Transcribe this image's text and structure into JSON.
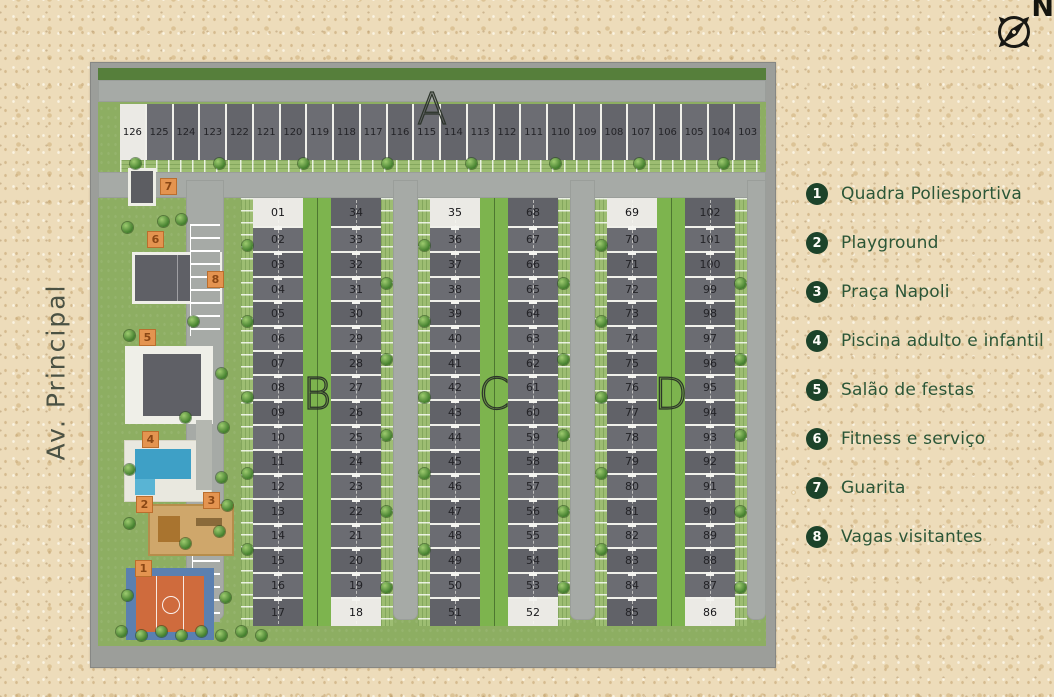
{
  "street_label": "Av. Principal",
  "compass": {
    "north_label": "N"
  },
  "legend": {
    "items": [
      {
        "num": "1",
        "label": "Quadra Poliesportiva"
      },
      {
        "num": "2",
        "label": "Playground"
      },
      {
        "num": "3",
        "label": "Praça Napoli"
      },
      {
        "num": "4",
        "label": "Piscina adulto e infantil"
      },
      {
        "num": "5",
        "label": "Salão de festas"
      },
      {
        "num": "6",
        "label": "Fitness e serviço"
      },
      {
        "num": "7",
        "label": "Guarita"
      },
      {
        "num": "8",
        "label": "Vagas visitantes"
      }
    ]
  },
  "map": {
    "row_a": {
      "label": "A",
      "lots": [
        "126",
        "125",
        "124",
        "123",
        "122",
        "121",
        "120",
        "119",
        "118",
        "117",
        "116",
        "115",
        "114",
        "113",
        "112",
        "111",
        "110",
        "109",
        "108",
        "107",
        "106",
        "105",
        "104",
        "103"
      ]
    },
    "blocks": [
      {
        "label": "B",
        "left_lots": [
          "01",
          "02",
          "03",
          "04",
          "05",
          "06",
          "07",
          "08",
          "09",
          "10",
          "11",
          "12",
          "13",
          "14",
          "15",
          "16",
          "17"
        ],
        "right_lots": [
          "34",
          "33",
          "32",
          "31",
          "30",
          "29",
          "28",
          "27",
          "26",
          "25",
          "24",
          "23",
          "22",
          "21",
          "20",
          "19",
          "18"
        ]
      },
      {
        "label": "C",
        "left_lots": [
          "35",
          "36",
          "37",
          "38",
          "39",
          "40",
          "41",
          "42",
          "43",
          "44",
          "45",
          "46",
          "47",
          "48",
          "49",
          "50",
          "51"
        ],
        "right_lots": [
          "68",
          "67",
          "66",
          "65",
          "64",
          "63",
          "62",
          "61",
          "60",
          "59",
          "58",
          "57",
          "56",
          "55",
          "54",
          "53",
          "52"
        ]
      },
      {
        "label": "D",
        "left_lots": [
          "69",
          "70",
          "71",
          "72",
          "73",
          "74",
          "75",
          "76",
          "77",
          "78",
          "79",
          "80",
          "81",
          "82",
          "83",
          "84",
          "85"
        ],
        "right_lots": [
          "102",
          "101",
          "100",
          "99",
          "98",
          "97",
          "96",
          "95",
          "94",
          "93",
          "92",
          "91",
          "90",
          "89",
          "88",
          "87",
          "86"
        ]
      }
    ],
    "highlighted_lots": [
      "126",
      "01",
      "18",
      "35",
      "52",
      "69",
      "86"
    ],
    "amenity_badges": [
      {
        "num": "7"
      },
      {
        "num": "6"
      },
      {
        "num": "8"
      },
      {
        "num": "5"
      },
      {
        "num": "4"
      },
      {
        "num": "3"
      },
      {
        "num": "2"
      },
      {
        "num": "1"
      }
    ],
    "colors": {
      "legend_green": "#1c432a",
      "legend_text": "#2b5637",
      "badge_orange": "#e49450",
      "grass": "#8dae62",
      "road_gray": "#a6aaa6",
      "lot_gray": "#616268",
      "highlight_lot": "#ebeae5",
      "court_orange": "#cf6b3d",
      "court_blue": "#5b80b0",
      "pool_blue": "#3ea0c6",
      "sand_background": "#eddcba"
    }
  }
}
